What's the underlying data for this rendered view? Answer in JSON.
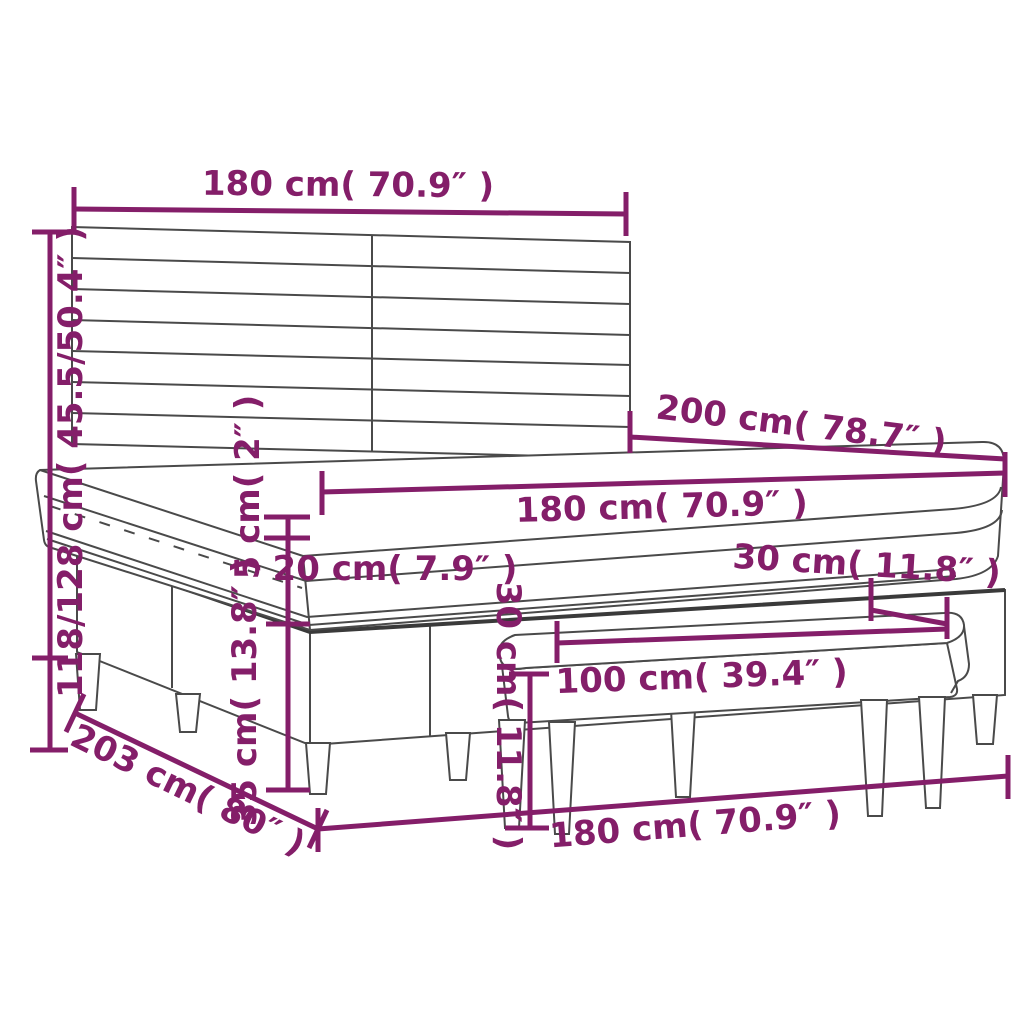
{
  "diagram": {
    "type": "furniture-dimension-diagram",
    "product": "box spring bed with headboard, pillow-top mattress and bench",
    "accent_color": "#841e69",
    "outline_color": "#4a4a4a",
    "dimensions": {
      "headboard_width": "180 cm( 70.9″ )",
      "total_height": "118/128 cm( 45.5/50.4″ )",
      "bed_length": "200 cm( 78.7″ )",
      "mattress_width": "180 cm( 70.9″ )",
      "topper_height": "5 cm( 2″ )",
      "mattress_height": "20 cm( 7.9″ )",
      "base_height": "35 cm( 13.8″ )",
      "bench_depth": "30 cm( 11.8″ )",
      "bench_length": "100 cm( 39.4″ )",
      "bench_height": "30 cm( 11.8″ )",
      "floor_length": "203 cm( 80″ )",
      "floor_width": "180 cm( 70.9″ )"
    }
  }
}
